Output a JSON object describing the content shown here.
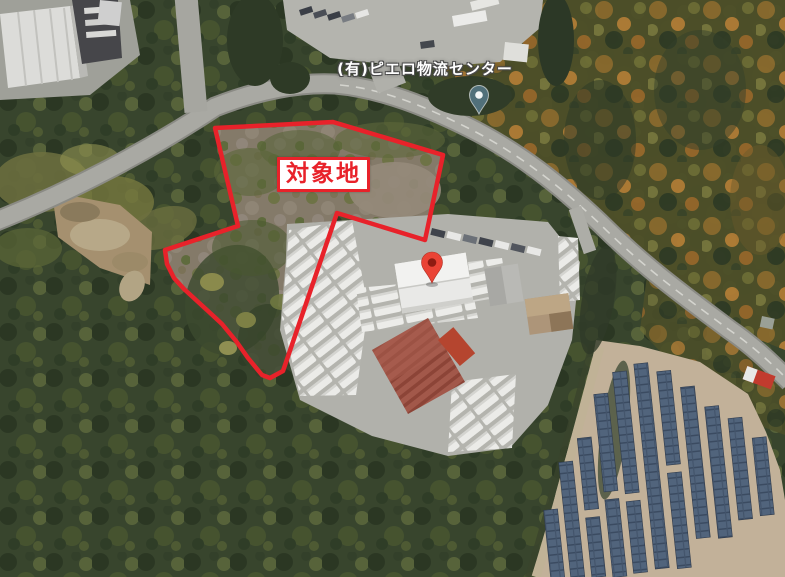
{
  "map": {
    "place_label": "(有)ピエロ物流センター",
    "site_label": "対象地",
    "annotation": {
      "polygon_points": "215,128 333,122 443,155 425,240 337,213 283,371 270,378 262,375 248,358 236,341 222,324 208,311 196,300 184,289 174,278 167,264 165,250 238,226",
      "stroke_color": "#e8222a",
      "stroke_width": "4.5"
    },
    "markers": {
      "destination_pin": {
        "transform": "translate(432,283)",
        "color": "#ea4335",
        "inner_color": "#8e1b12"
      },
      "place_pin": {
        "transform": "translate(479,114)",
        "color": "#51707a",
        "inner_color": "#f2f5f5"
      }
    }
  },
  "theme": {
    "annotation_red": "#e8222a",
    "label_bg": "#ffffff",
    "forest_dark": "#38452d",
    "forest_autumn": "#8a6a2d",
    "scrub_brown": "#847a69",
    "road_gray": "#a9a9a3",
    "pavement_gray": "#b1b1ab",
    "solar_ground_tan": "#c2b199",
    "solar_panel_blue": "#51647c"
  }
}
